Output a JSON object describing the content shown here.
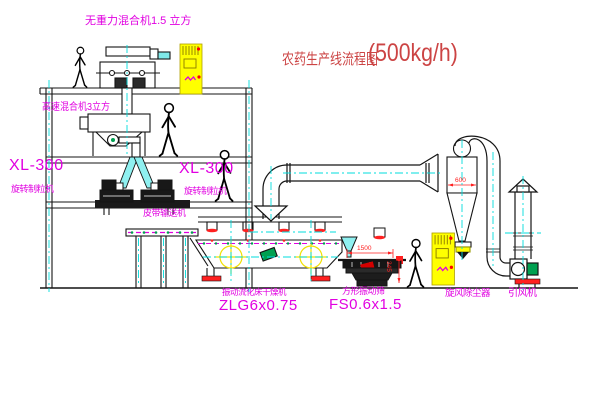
{
  "title": {
    "text": "农药生产线流程图",
    "capacity": "(500kg/h)"
  },
  "equipment": {
    "gravity_mixer": {
      "label": "无重力混合机1.5 立方"
    },
    "high_speed_mixer": {
      "label": "高速混合机3立方"
    },
    "granulator_left": {
      "model": "XL-300",
      "name": "旋转制粒机"
    },
    "granulator_right": {
      "model": "XL-300",
      "name": "旋转制粒机"
    },
    "belt_conveyor": {
      "name": "皮带输送机"
    },
    "fluid_bed_dryer": {
      "name": "振动流化床干燥机",
      "model": "ZLG6x0.75"
    },
    "vibrating_screen": {
      "name": "方形振动筛",
      "model": "FS0.6x1.5"
    },
    "cyclone": {
      "name": "旋风除尘器"
    },
    "induced_draft_fan": {
      "name": "引风机"
    }
  },
  "dimensions": {
    "screen_length": "1500",
    "screen_height": "345",
    "cyclone_diameter": "600"
  },
  "colors": {
    "label_magenta": "#e100e1",
    "title_red": "#cc4444",
    "dimension_red": "#ff2020",
    "centerline_cyan": "#00dcdc",
    "cabinet_yellow": "#ffff00",
    "accent_green": "#00a050",
    "line_black": "#141414"
  }
}
